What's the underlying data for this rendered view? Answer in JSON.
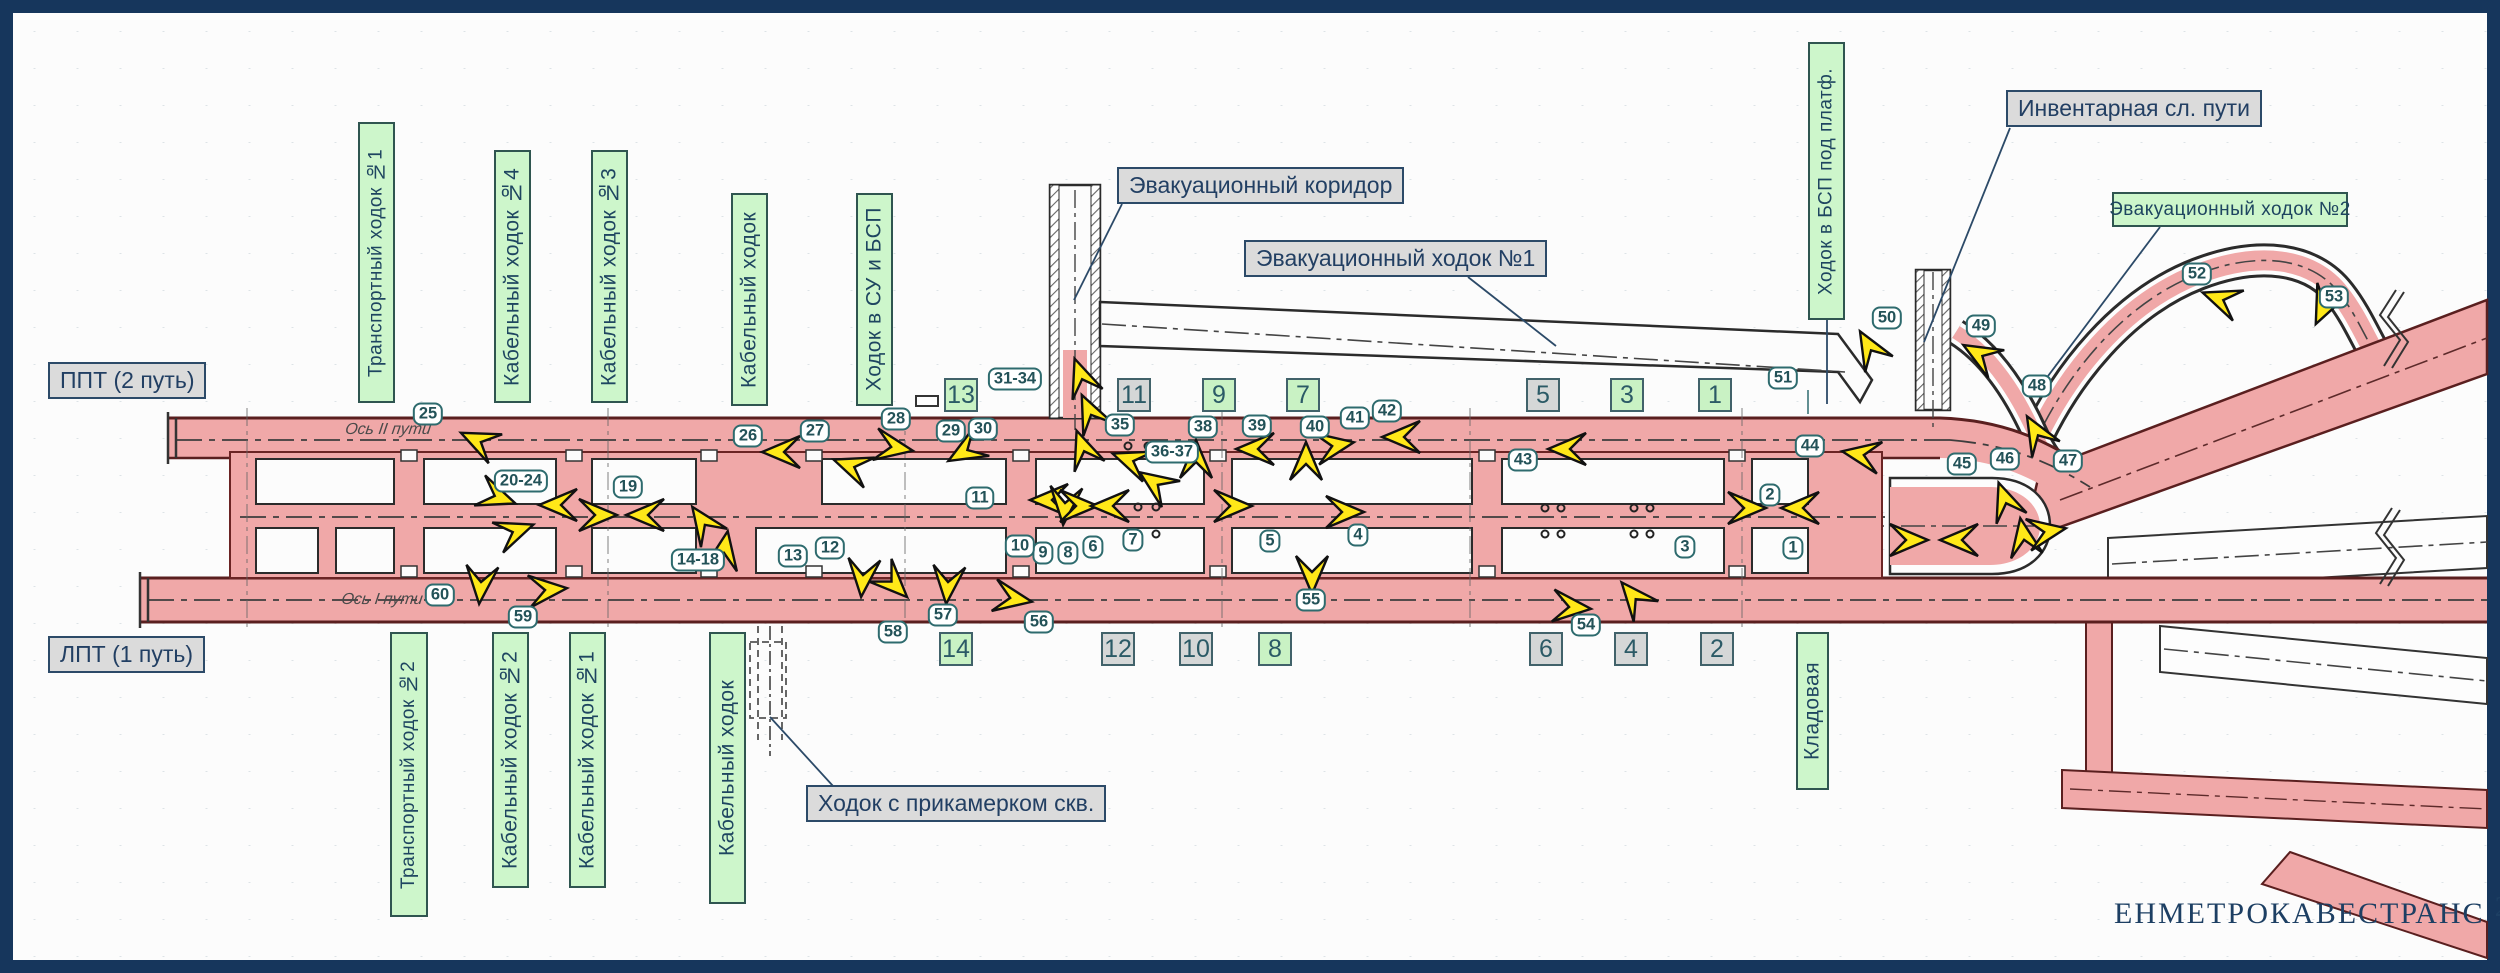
{
  "logo": {
    "text": "ЕНМЕТРОКАВЕСТРАНС",
    "year": "2021"
  },
  "colors": {
    "frame_navy": "#16365c",
    "tunnel_pink": "#f0a8a8",
    "tunnel_edge": "#5a1f1f",
    "label_green": "#cdf6cb",
    "label_gray": "#dbdbdb",
    "line_navy": "#2c4a68",
    "marker_teal": "#2e6b6e",
    "arrow_yellow": "#ffe818",
    "square_green": "#c9f2c4",
    "square_gray": "#d5d7d7"
  },
  "axis_labels": [
    {
      "text": "Ось II пути",
      "x": 388,
      "y": 430
    },
    {
      "text": "Ось I пути",
      "x": 382,
      "y": 600
    }
  ],
  "callouts": [
    {
      "text": "ППТ (2 путь)",
      "x": 48,
      "y": 362
    },
    {
      "text": "ЛПТ (1 путь)",
      "x": 48,
      "y": 636
    },
    {
      "text": "Эвакуационный коридор",
      "x": 1117,
      "y": 167,
      "leader": [
        1122,
        204,
        1074,
        300
      ]
    },
    {
      "text": "Эвакуационный ходок №1",
      "x": 1244,
      "y": 240,
      "leader": [
        1468,
        277,
        1556,
        346
      ]
    },
    {
      "text": "Инвентарная сл. пути",
      "x": 2006,
      "y": 90,
      "leader": [
        2010,
        128,
        1924,
        342
      ]
    },
    {
      "text": "Ходок с прикамерком скв.",
      "x": 806,
      "y": 785,
      "leader": [
        833,
        786,
        770,
        717
      ]
    }
  ],
  "green_labels": [
    {
      "text": "Транспортный ходок №1",
      "o": "v",
      "x": 358,
      "y": 122,
      "w": 37,
      "h": 281
    },
    {
      "text": "Кабельный ходок №4",
      "o": "v",
      "x": 494,
      "y": 150,
      "w": 37,
      "h": 253
    },
    {
      "text": "Кабельный ходок №3",
      "o": "v",
      "x": 591,
      "y": 150,
      "w": 37,
      "h": 253
    },
    {
      "text": "Кабельный ходок",
      "o": "v",
      "x": 731,
      "y": 193,
      "w": 37,
      "h": 213
    },
    {
      "text": "Ходок в СУ и БСП",
      "o": "v",
      "x": 856,
      "y": 193,
      "w": 37,
      "h": 213
    },
    {
      "text": "Ходок в БСП под платф.",
      "o": "v",
      "x": 1808,
      "y": 42,
      "w": 37,
      "h": 278,
      "leader": [
        1827,
        320,
        1827,
        404
      ]
    },
    {
      "text": "Эвакуационный ходок №2",
      "o": "h",
      "x": 2112,
      "y": 192,
      "w": 236,
      "h": 35,
      "leader": [
        2160,
        227,
        2036,
        392
      ]
    },
    {
      "text": "Транспортный ходок №2",
      "o": "v",
      "x": 390,
      "y": 632,
      "w": 38,
      "h": 285
    },
    {
      "text": "Кабельный ходок №2",
      "o": "v",
      "x": 492,
      "y": 632,
      "w": 37,
      "h": 256
    },
    {
      "text": "Кабельный ходок №1",
      "o": "v",
      "x": 569,
      "y": 632,
      "w": 37,
      "h": 256
    },
    {
      "text": "Кабельный ходок",
      "o": "v",
      "x": 709,
      "y": 632,
      "w": 37,
      "h": 272
    },
    {
      "text": "Кладовая",
      "o": "v",
      "x": 1796,
      "y": 632,
      "w": 33,
      "h": 158
    }
  ],
  "room_squares": [
    {
      "n": "13",
      "color": "green",
      "x": 961,
      "y": 395
    },
    {
      "n": "11",
      "color": "gray",
      "x": 1134,
      "y": 395
    },
    {
      "n": "9",
      "color": "green",
      "x": 1219,
      "y": 395
    },
    {
      "n": "7",
      "color": "green",
      "x": 1303,
      "y": 395
    },
    {
      "n": "5",
      "color": "gray",
      "x": 1543,
      "y": 395
    },
    {
      "n": "3",
      "color": "green",
      "x": 1627,
      "y": 395
    },
    {
      "n": "1",
      "color": "green",
      "x": 1715,
      "y": 395
    },
    {
      "n": "14",
      "color": "green",
      "x": 956,
      "y": 649
    },
    {
      "n": "12",
      "color": "gray",
      "x": 1118,
      "y": 649
    },
    {
      "n": "10",
      "color": "gray",
      "x": 1196,
      "y": 649
    },
    {
      "n": "8",
      "color": "green",
      "x": 1275,
      "y": 649
    },
    {
      "n": "6",
      "color": "gray",
      "x": 1546,
      "y": 649
    },
    {
      "n": "4",
      "color": "gray",
      "x": 1631,
      "y": 649
    },
    {
      "n": "2",
      "color": "gray",
      "x": 1717,
      "y": 649
    }
  ],
  "point_markers": [
    {
      "label": "1",
      "x": 1793,
      "y": 548
    },
    {
      "label": "2",
      "x": 1770,
      "y": 495
    },
    {
      "label": "3",
      "x": 1685,
      "y": 547
    },
    {
      "label": "4",
      "x": 1358,
      "y": 535
    },
    {
      "label": "5",
      "x": 1270,
      "y": 541
    },
    {
      "label": "6",
      "x": 1093,
      "y": 547
    },
    {
      "label": "7",
      "x": 1133,
      "y": 540
    },
    {
      "label": "8",
      "x": 1068,
      "y": 553
    },
    {
      "label": "9",
      "x": 1043,
      "y": 553
    },
    {
      "label": "10",
      "x": 1020,
      "y": 546
    },
    {
      "label": "11",
      "x": 980,
      "y": 498
    },
    {
      "label": "12",
      "x": 830,
      "y": 548
    },
    {
      "label": "13",
      "x": 793,
      "y": 556
    },
    {
      "label": "14-18",
      "x": 698,
      "y": 560
    },
    {
      "label": "19",
      "x": 628,
      "y": 487
    },
    {
      "label": "20-24",
      "x": 521,
      "y": 481
    },
    {
      "label": "25",
      "x": 428,
      "y": 414
    },
    {
      "label": "26",
      "x": 748,
      "y": 436
    },
    {
      "label": "27",
      "x": 815,
      "y": 431
    },
    {
      "label": "28",
      "x": 896,
      "y": 419
    },
    {
      "label": "29",
      "x": 951,
      "y": 431
    },
    {
      "label": "30",
      "x": 983,
      "y": 429
    },
    {
      "label": "31-34",
      "x": 1015,
      "y": 379
    },
    {
      "label": "35",
      "x": 1120,
      "y": 425
    },
    {
      "label": "36-37",
      "x": 1172,
      "y": 452
    },
    {
      "label": "38",
      "x": 1203,
      "y": 427
    },
    {
      "label": "39",
      "x": 1257,
      "y": 426
    },
    {
      "label": "40",
      "x": 1315,
      "y": 427
    },
    {
      "label": "41",
      "x": 1355,
      "y": 418
    },
    {
      "label": "42",
      "x": 1387,
      "y": 411
    },
    {
      "label": "43",
      "x": 1523,
      "y": 460
    },
    {
      "label": "44",
      "x": 1810,
      "y": 446
    },
    {
      "label": "45",
      "x": 1962,
      "y": 464
    },
    {
      "label": "46",
      "x": 2005,
      "y": 459
    },
    {
      "label": "47",
      "x": 2068,
      "y": 461
    },
    {
      "label": "48",
      "x": 2037,
      "y": 386
    },
    {
      "label": "49",
      "x": 1981,
      "y": 326
    },
    {
      "label": "50",
      "x": 1887,
      "y": 318
    },
    {
      "label": "51",
      "x": 1783,
      "y": 378
    },
    {
      "label": "52",
      "x": 2197,
      "y": 274
    },
    {
      "label": "53",
      "x": 2334,
      "y": 297
    },
    {
      "label": "54",
      "x": 1586,
      "y": 625
    },
    {
      "label": "55",
      "x": 1311,
      "y": 600
    },
    {
      "label": "56",
      "x": 1039,
      "y": 622
    },
    {
      "label": "57",
      "x": 943,
      "y": 615
    },
    {
      "label": "58",
      "x": 893,
      "y": 632
    },
    {
      "label": "59",
      "x": 523,
      "y": 617
    },
    {
      "label": "60",
      "x": 440,
      "y": 595
    }
  ],
  "arrows": [
    [
      470,
      437,
      205
    ],
    [
      506,
      500,
      20
    ],
    [
      549,
      505,
      180
    ],
    [
      524,
      528,
      340
    ],
    [
      607,
      515,
      0
    ],
    [
      636,
      515,
      180
    ],
    [
      698,
      515,
      235
    ],
    [
      726,
      541,
      280
    ],
    [
      480,
      594,
      95
    ],
    [
      557,
      589,
      355
    ],
    [
      772,
      452,
      180
    ],
    [
      843,
      463,
      200
    ],
    [
      903,
      449,
      10
    ],
    [
      957,
      456,
      150
    ],
    [
      1078,
      368,
      250
    ],
    [
      1086,
      404,
      245
    ],
    [
      1080,
      440,
      250
    ],
    [
      1122,
      457,
      200
    ],
    [
      1148,
      478,
      215
    ],
    [
      1040,
      500,
      180
    ],
    [
      1064,
      515,
      95
    ],
    [
      1088,
      506,
      0
    ],
    [
      1101,
      506,
      180
    ],
    [
      1242,
      506,
      0
    ],
    [
      1196,
      450,
      270
    ],
    [
      1246,
      449,
      180
    ],
    [
      1306,
      452,
      270
    ],
    [
      1344,
      444,
      350
    ],
    [
      1392,
      437,
      180
    ],
    [
      1354,
      512,
      0
    ],
    [
      1558,
      449,
      180
    ],
    [
      1756,
      508,
      0
    ],
    [
      1791,
      508,
      180
    ],
    [
      1312,
      584,
      90
    ],
    [
      1581,
      608,
      5
    ],
    [
      1628,
      590,
      230
    ],
    [
      1022,
      600,
      10
    ],
    [
      947,
      594,
      95
    ],
    [
      900,
      590,
      45
    ],
    [
      862,
      587,
      95
    ],
    [
      1852,
      453,
      190
    ],
    [
      1918,
      540,
      0
    ],
    [
      1950,
      540,
      180
    ],
    [
      1865,
      340,
      240
    ],
    [
      1972,
      350,
      210
    ],
    [
      2032,
      425,
      240
    ],
    [
      2002,
      492,
      250
    ],
    [
      2022,
      528,
      260
    ],
    [
      2056,
      530,
      350
    ],
    [
      2212,
      296,
      200
    ],
    [
      2320,
      315,
      115
    ]
  ]
}
